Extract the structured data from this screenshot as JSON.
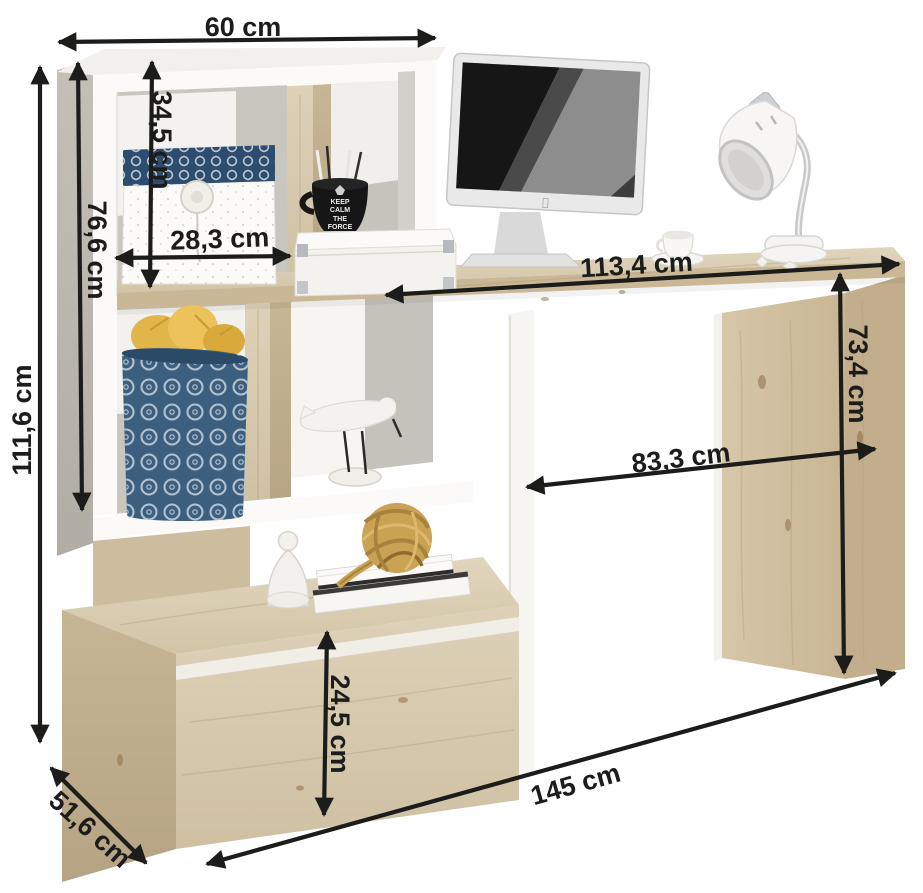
{
  "dimensions": {
    "top_width": "60 cm",
    "total_height": "111,6 cm",
    "hutch_height": "76,6 cm",
    "top_compartment_height": "34,5 cm",
    "compartment_width": "28,3 cm",
    "desktop_length": "113,4 cm",
    "desk_height": "73,4 cm",
    "knee_clearance_width": "83,3 cm",
    "drawer_height": "24,5 cm",
    "total_width": "145 cm",
    "depth": "51,6 cm"
  },
  "mug": {
    "lines": [
      "KEEP",
      "CALM",
      "THE",
      "FORCE"
    ]
  },
  "colors": {
    "annotation": "#1c1c1b",
    "frame_white": "#fafaf8",
    "side_grey": "#bdb9b1",
    "wood_light": "#dbceb4",
    "wood_mid": "#cfc0a2",
    "wood_dark": "#c3b091",
    "basket_blue": "#3c5f80",
    "lid_blue": "#2e4d6e",
    "fabric_yellow": "#e2b54b",
    "rope_tan": "#c9a254"
  }
}
